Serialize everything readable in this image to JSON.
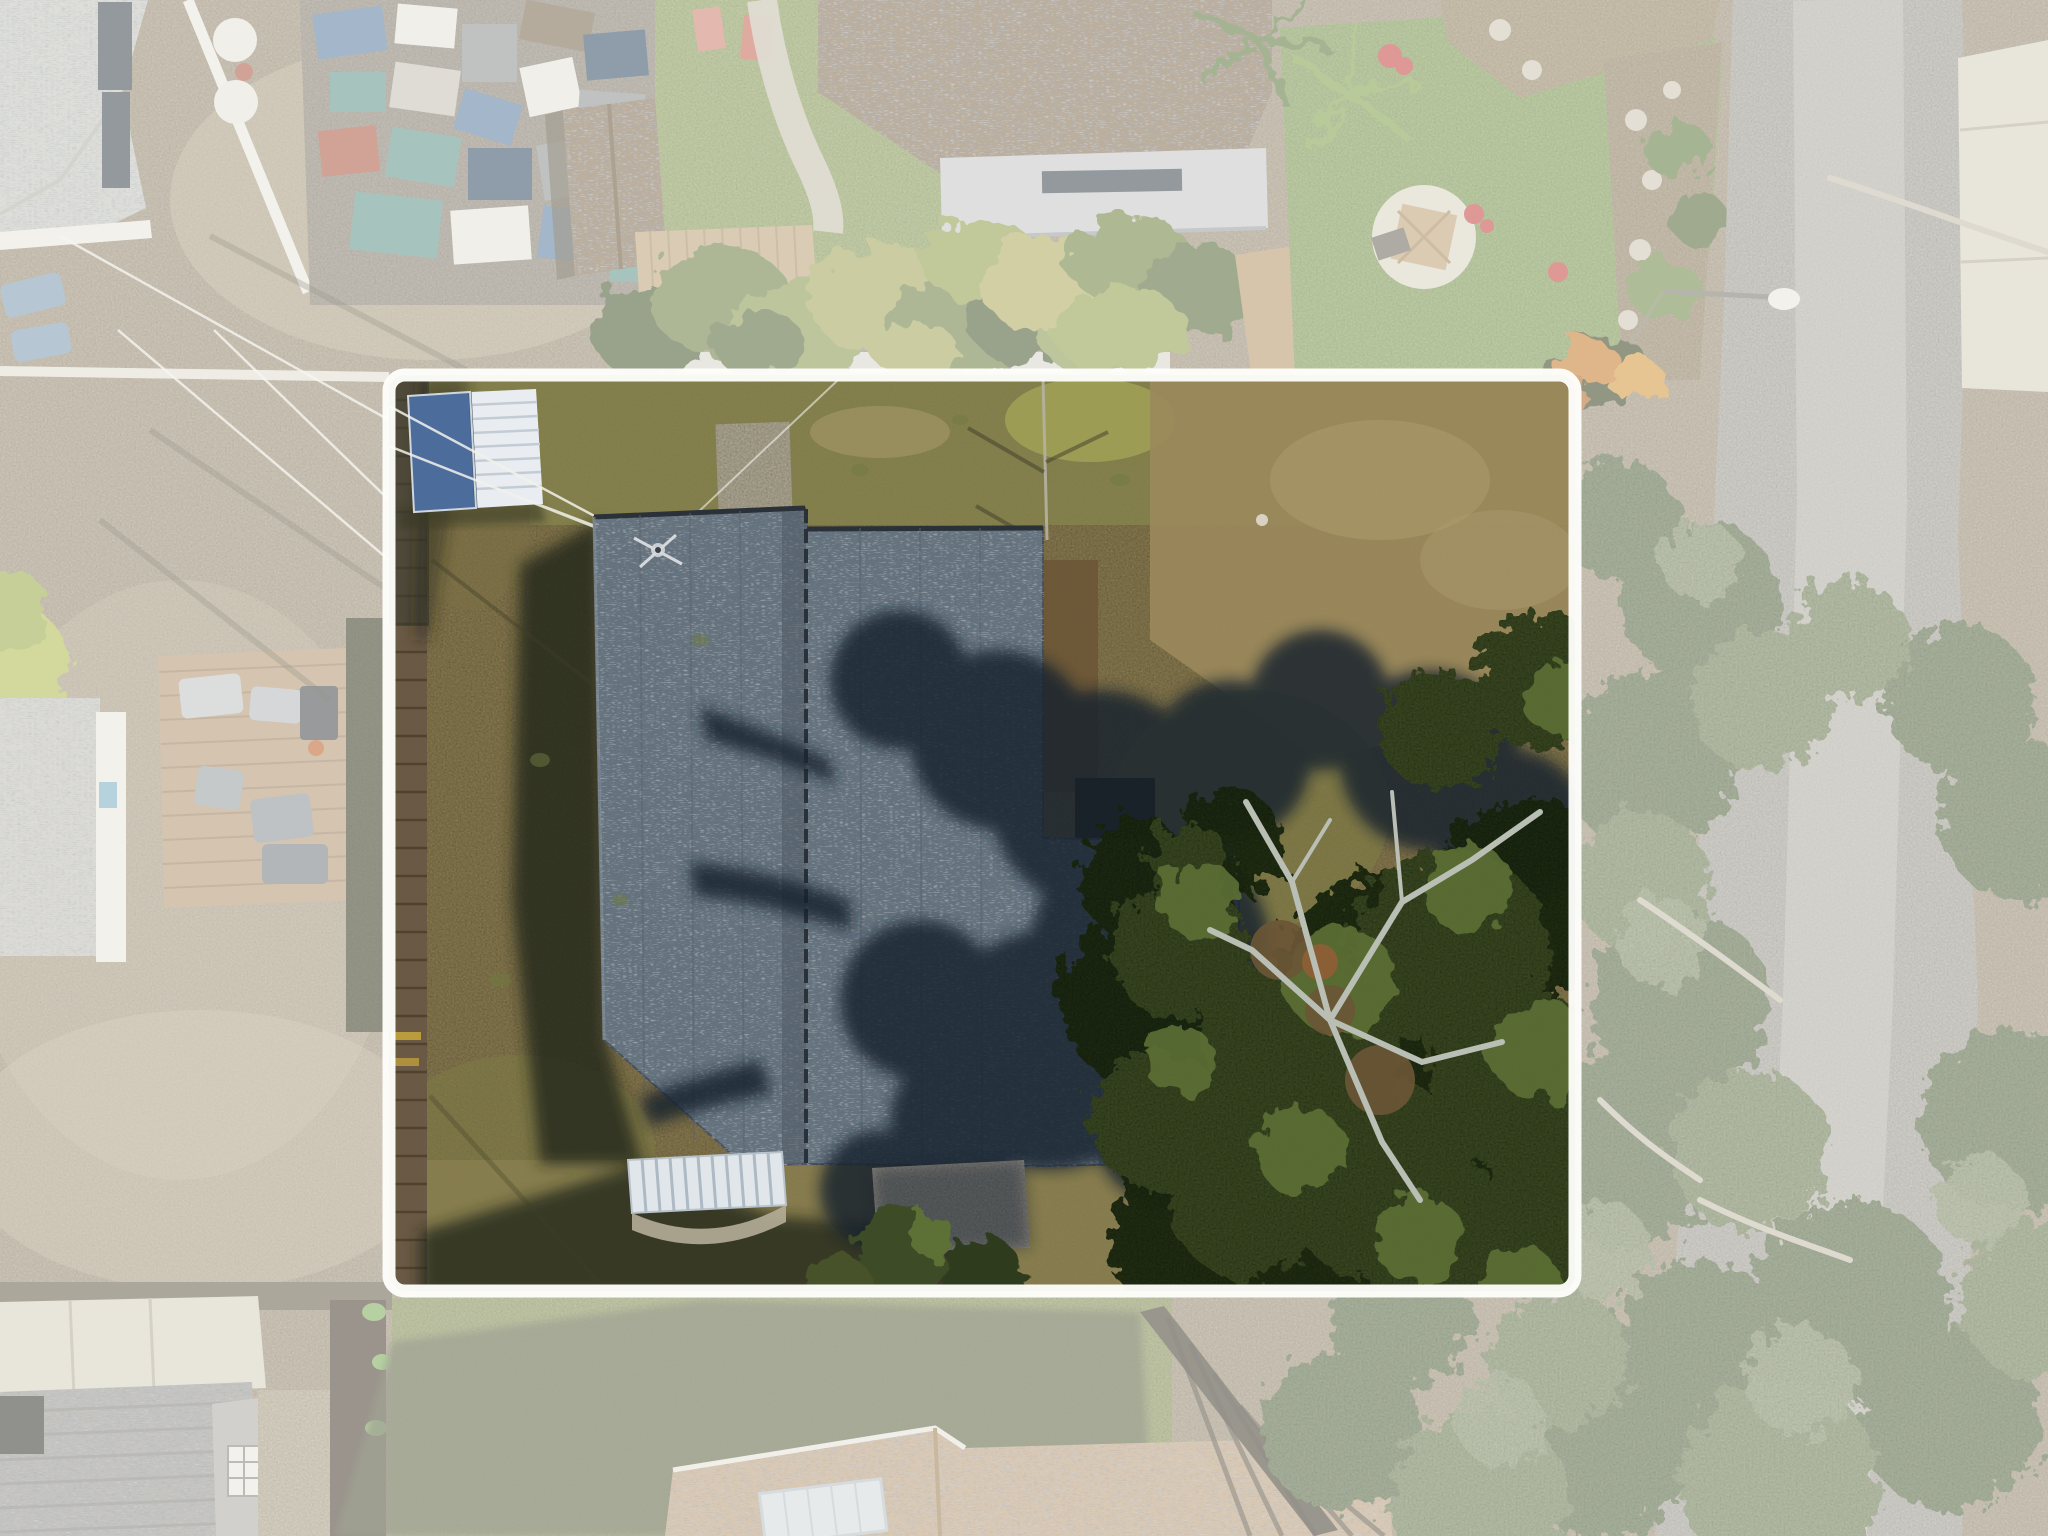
{
  "image": {
    "kind": "aerial-drone-photograph",
    "view": "top-down nadir view of residential neighborhood",
    "subject": "single-family lot highlighted with a white boundary outline; gray architectural-shingle roof house, small blue-and-white metal shed, large live oak over right half of lot",
    "visible_text": "none"
  },
  "boundary": {
    "shape": "rounded-rectangle",
    "x": 389,
    "y": 375,
    "width": 1186,
    "height": 916,
    "corner_radius": 16,
    "stroke_width": 13,
    "color": "#fdfdfa"
  },
  "effects": {
    "wash_opacity": "0.45",
    "description": "everything outside the boundary is desaturated / washed out with a milky white overlay"
  },
  "features": {
    "subject_lot": {
      "house_roof": "gray shingle roof, vertical ridge, L-shaped wing lower right, mostly under oak-tree shadow on right half",
      "antenna": "small TV antenna upper-left of roof with guy wires",
      "awning": "white ribbed metal awning with curved concrete pad at bottom of house",
      "shed": "outbuilding top-left of lot, roof half steel-blue half white ribbed",
      "oak_tree": "large live oak canopy with gray branches over lower-right of lot",
      "ground": "dry olive-brown winter lawn with concrete remnant pad near top",
      "left_fence": "wood privacy fence along left boundary",
      "power_lines": "thin wires crossing the yard toward the roof antenna"
    },
    "surroundings": {
      "top_left": "light gray roof home, blue lawn chairs, dirt yard and cluttered storage yard with tarps and bins",
      "top_middle": "brown shingle shed and large brown roof house with gray porch roof, green lawn, stone path, wood deck",
      "top_right": "landscaped lawn with gazebo on gravel circle, red flowers, stone-and-mulch garden beds, palms",
      "right": "asphalt street running vertically, street light on arm, concrete driveway pad upper right, oak canopy over road lower right",
      "left": "neighbor home with light roof and wood deck with patio furniture, dark hedge fence",
      "bottom": "neighbor homes: gray shingle roof with dormer window and white driveway (left), tan roof with skylight (middle), slat fence, long house shadows"
    }
  },
  "colors": {
    "out_ground": "#b1a289",
    "out_dirt_light": "#c4b59a",
    "out_lawn": "#9cb169",
    "out_lawn_bright": "#8fae62",
    "road": "#b6b2ab",
    "road_light": "#c6c2bb",
    "concrete": "#d9d3c5",
    "concrete_seam": "#b7b0a0",
    "white_structure": "#eceae2",
    "roof_gray_light": "#cbcbc6",
    "roof_brown": "#8b7252",
    "porch_gray": "#c6c9ca",
    "window_dark": "#3e4953",
    "deck_tan": "#c0a67e",
    "deck_line": "#9c8260",
    "clutter_blue": "#5b7ea6",
    "clutter_teal": "#61988f",
    "clutter_white": "#e8e6df",
    "clutter_gray": "#8f9496",
    "clutter_navy": "#35506b",
    "clutter_brown": "#7a6a52",
    "clutter_red": "#b05b4a",
    "toy_pink": "#d08276",
    "stone_path": "#c9c3b5",
    "bush_green": "#6d8044",
    "bush_yellow": "#a7a75f",
    "bush_dark": "#4a5a33",
    "gazebo_gravel": "#ddd7c9",
    "gazebo_roof": "#c2a47c",
    "flower_red": "#c64848",
    "mulch_bed": "#ab9876",
    "orange_plant": "#c97f33",
    "tree_wash": "#7f9065",
    "tree_wash_dark": "#687a52",
    "tree_wash_light": "#95a37c",
    "branch_wash": "#c6c0b0",
    "lot_grass": "#8c7e52",
    "lot_grass_green": "#7d7a46",
    "lot_grass_olive": "#85834e",
    "lot_grass_brown": "#9b8a5c",
    "lot_grass_dry": "#ab9c6e",
    "lot_dirt": "#6b5636",
    "dirt_orange": "#8a5f35",
    "fence_wood": "#6a5944",
    "fence_plank": "#4b3d2c",
    "fence_dark": "#3c3426",
    "hedge_dark": "#474a33",
    "shed_blue": "#4c6c9c",
    "shed_white": "#e9edf1",
    "shed_stripe": "#c3ccd4",
    "roof": "#68747f",
    "roof_dark": "#4e5862",
    "roof_light": "#93a0ac",
    "roof_edge": "#2a3138",
    "shadow_navy": "#16222e",
    "shadow_ground": "#23281c",
    "shadow_olive": "#565c42",
    "awning": "#e1e6eb",
    "awning_rib": "#adb9c3",
    "pad_concrete": "#b5ae99",
    "slab_gray": "#97938a",
    "canopy_dark": "#242e19",
    "canopy": "#3c4b27",
    "canopy_light": "#5d7034",
    "branch_gray": "#b9bfb4",
    "wire": "#f3f2ec",
    "boundary_white": "#fdfdfa",
    "wash": "#fbfaf6",
    "house_gray_bl": "#9c9a96",
    "tan_roof": "#c2a37e",
    "skylight": "#d7dde2"
  }
}
